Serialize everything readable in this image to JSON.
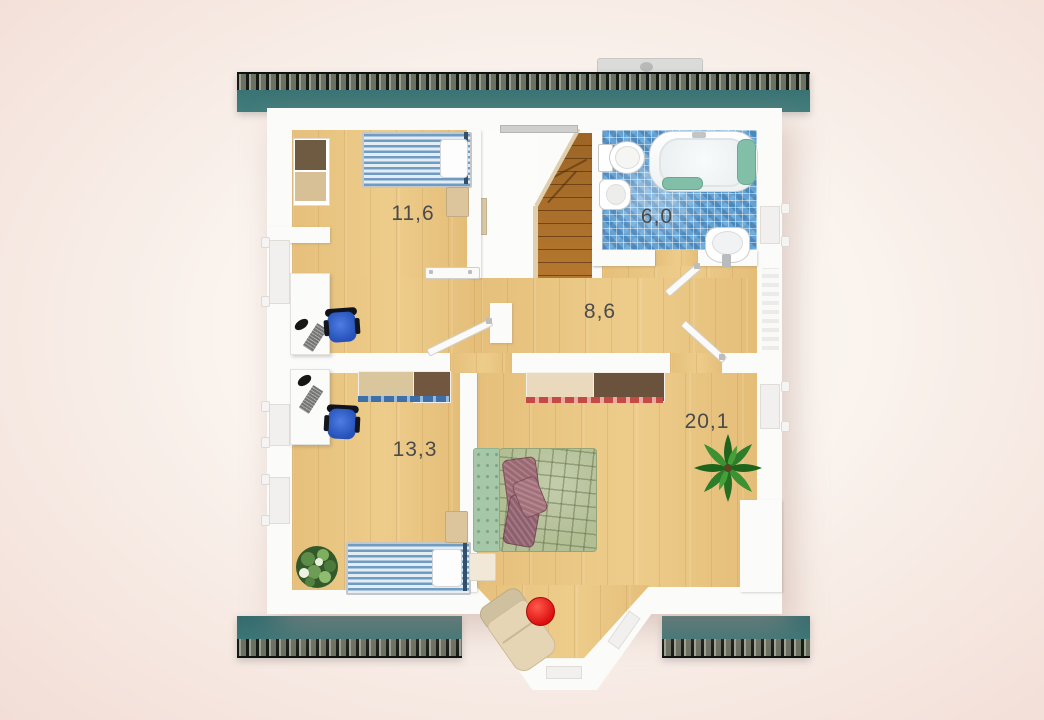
{
  "floorplan": {
    "title": "upper-floor-plan",
    "rooms": [
      {
        "name": "bedroom-upper-left",
        "area_label": "11,6"
      },
      {
        "name": "bathroom",
        "area_label": "6,0"
      },
      {
        "name": "hallway",
        "area_label": "8,6"
      },
      {
        "name": "room-lower-left",
        "area_label": "13,3"
      },
      {
        "name": "master-bedroom",
        "area_label": "20,1"
      }
    ],
    "fixtures": [
      "bathtub",
      "toilet",
      "bidet",
      "sink",
      "stairs",
      "bay-window"
    ],
    "furniture": [
      "single-bed",
      "single-bed",
      "double-bed",
      "desk",
      "desk",
      "office-chair",
      "office-chair",
      "wardrobe",
      "storage-cabinets",
      "nightstand",
      "plant",
      "palm-plant",
      "lounge-chair",
      "red-stool"
    ],
    "colors": {
      "roof_teal": "#3d7477",
      "floor_wood": "#ebc884",
      "bathroom_tile": "#64a2d2",
      "wall_white": "#fbfbfa",
      "background_edge": "#f2ded6",
      "chair_blue": "#2e5cc8",
      "bed_stripe_blue": "#6f9cc2",
      "duvet_green": "#b2bf95",
      "accent_red": "#dd1111",
      "label_text": "#4b4b4b"
    }
  }
}
